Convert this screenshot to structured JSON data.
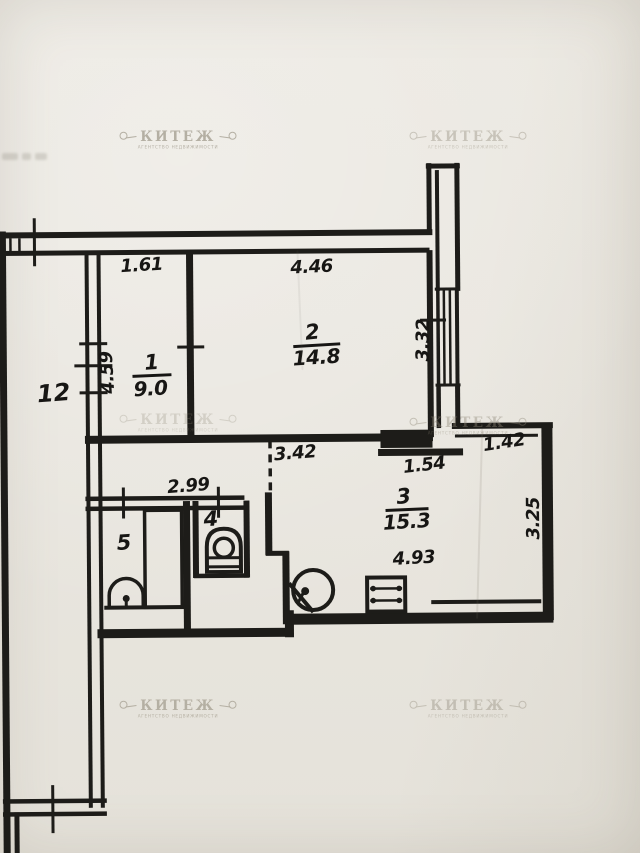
{
  "document": {
    "type": "apartment-floor-plan"
  },
  "watermark": {
    "brand": "КИТЕЖ",
    "subtitle": "АГЕНТСТВО НЕДВИЖИМОСТИ"
  },
  "colors": {
    "ink": "#1d1c19",
    "paper": "#e9e6df",
    "watermark": "#8d8676"
  },
  "rooms": [
    {
      "number": "1",
      "area": "9.0"
    },
    {
      "number": "2",
      "area": "14.8"
    },
    {
      "number": "3",
      "area": "15.3"
    },
    {
      "number": "4"
    },
    {
      "number": "5"
    },
    {
      "number": "12"
    }
  ],
  "dimensions": [
    {
      "label": "1.61",
      "edge": "room-1-top"
    },
    {
      "label": "4.46",
      "edge": "room-2-top"
    },
    {
      "label": "3.32",
      "edge": "room-2-right"
    },
    {
      "label": "4.59",
      "edge": "room-1-left"
    },
    {
      "label": "3.42",
      "edge": "hall-top"
    },
    {
      "label": "1.54",
      "edge": "room-3-top"
    },
    {
      "label": "1.42",
      "edge": "room-3-top-right"
    },
    {
      "label": "3.25",
      "edge": "room-3-right"
    },
    {
      "label": "4.93",
      "edge": "room-3-bottom"
    },
    {
      "label": "2.99",
      "edge": "hall-width"
    }
  ],
  "fixtures": [
    {
      "name": "bathtub",
      "room": "5"
    },
    {
      "name": "washbasin",
      "room": "5"
    },
    {
      "name": "toilet",
      "room": "4"
    },
    {
      "name": "corner-sink",
      "room": "3"
    },
    {
      "name": "stove",
      "room": "3"
    }
  ]
}
